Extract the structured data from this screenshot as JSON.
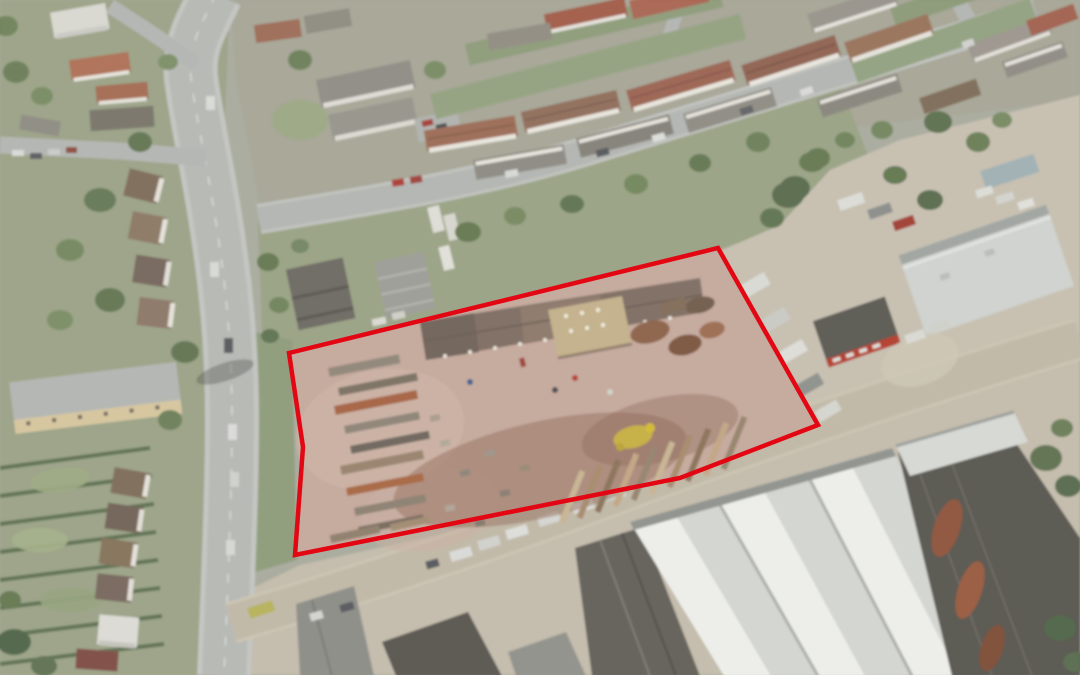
{
  "page": {
    "title": "Aerial site location photograph",
    "description": "Oblique aerial photograph of an industrial scrapyard site outlined with a red boundary line, bordered by a main road to the west, terraced housing and a residential street to the north, and large warehouse units to the south-east."
  },
  "annotation": {
    "site_boundary": {
      "color": "#e30613",
      "stroke_width": 4.5,
      "points": [
        [
          289,
          353
        ],
        [
          718,
          248
        ],
        [
          818,
          425
        ],
        [
          680,
          478
        ],
        [
          295,
          555
        ],
        [
          303,
          447
        ]
      ]
    }
  },
  "scene": {
    "regions": [
      {
        "id": "scrapyard-site",
        "label": "Scrapyard site (red outline)"
      },
      {
        "id": "main-road",
        "label": "Main road, west side"
      },
      {
        "id": "residential-street",
        "label": "Residential street, north"
      },
      {
        "id": "terraced-housing",
        "label": "Terraced housing rows"
      },
      {
        "id": "industrial-units",
        "label": "Warehouse / industrial units, south-east"
      },
      {
        "id": "gardens",
        "label": "Back gardens and trees"
      }
    ],
    "palette": {
      "ground": "#a7a99b",
      "site_ground": "#c3a79a",
      "road": "#b5b7b3",
      "industrial_yard": "#c2baa9",
      "vegetation": "#93a07e",
      "roof_red": "#9a6a54",
      "roof_grey": "#8e8a82",
      "warehouse_white": "#e2e3df",
      "warehouse_dark": "#55534c"
    }
  }
}
